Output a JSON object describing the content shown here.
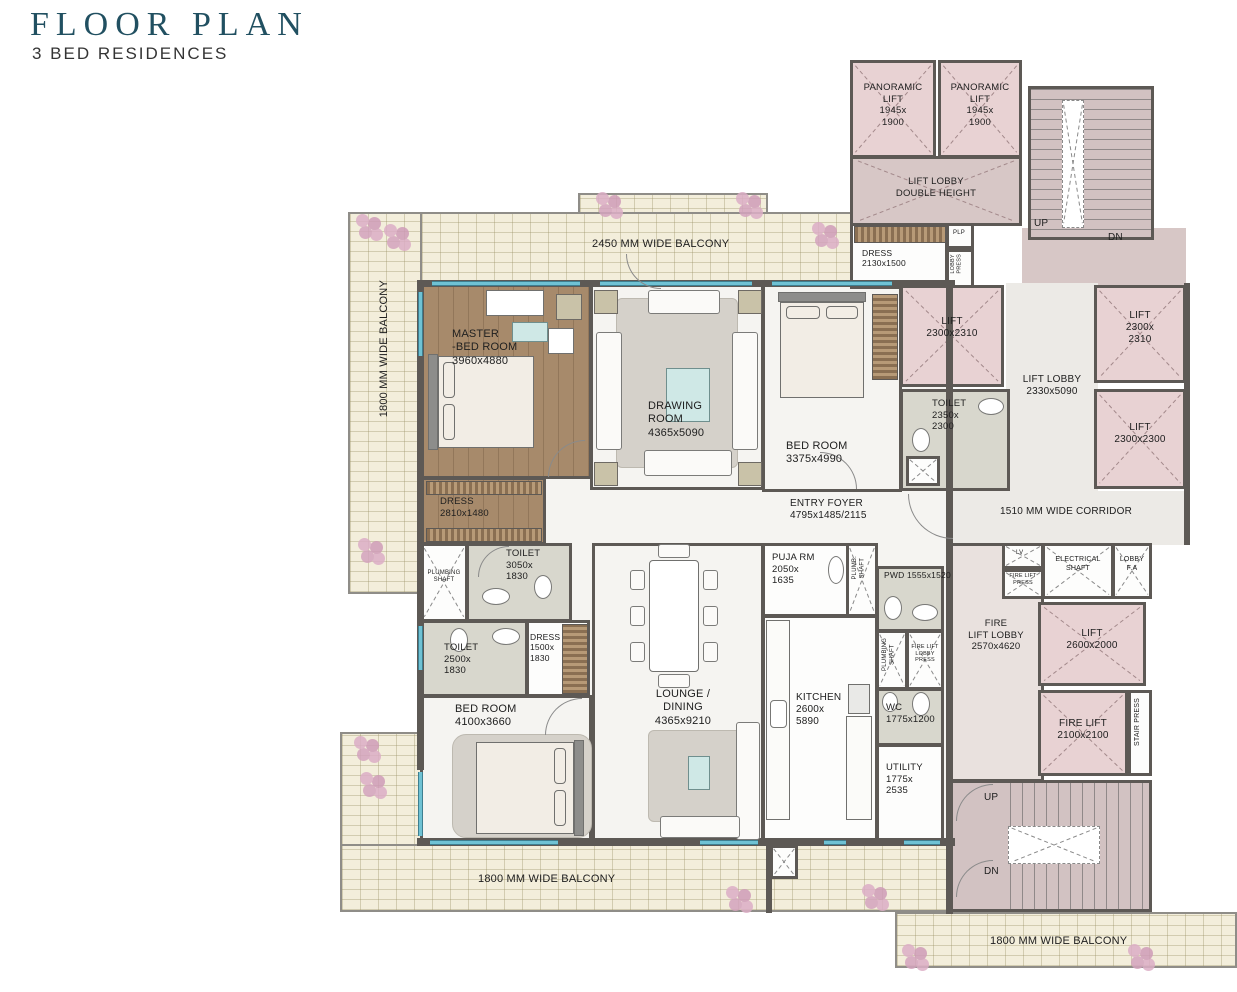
{
  "header": {
    "title": "FLOOR PLAN",
    "subtitle": "3 BED RESIDENCES"
  },
  "colors": {
    "accent_teal": "#215061",
    "wall": "#5d5955",
    "lift_fill": "#e8d2d3",
    "lobby_fill": "#d7c7c6",
    "balcony_tile": "#f3eedb",
    "wood_floor": "#a78a6b",
    "window_glass": "#6fc2d4"
  },
  "balconies": {
    "top": "2450 MM WIDE BALCONY",
    "left": "1800 MM WIDE BALCONY",
    "bottom": "1800 MM WIDE BALCONY",
    "bottom_right": "1800 MM WIDE BALCONY"
  },
  "corridor": {
    "label": "1510 MM WIDE CORRIDOR"
  },
  "stairs": {
    "up": "UP",
    "dn": "DN"
  },
  "rooms": {
    "panoramic_lift": {
      "name": "PANORAMIC\nLIFT",
      "dims": "1945x\n1900"
    },
    "lift_lobby_dh": {
      "name": "LIFT LOBBY\nDOUBLE HEIGHT"
    },
    "dress_top": {
      "name": "DRESS",
      "dims": "2130x1500"
    },
    "plp": {
      "name": "PLP"
    },
    "lobby_press": {
      "name": "LOBBY\nPRESS"
    },
    "master": {
      "name": "MASTER\n-BED ROOM",
      "dims": "3960x4880"
    },
    "drawing": {
      "name": "DRAWING\nROOM",
      "dims": "4365x5090"
    },
    "bed2": {
      "name": "BED ROOM",
      "dims": "3375x4990"
    },
    "lift_a": {
      "name": "LIFT",
      "dims": "2300x2310"
    },
    "toilet3": {
      "name": "TOILET",
      "dims": "2350x\n2300"
    },
    "lift_lobby": {
      "name": "LIFT LOBBY",
      "dims": "2330x5090"
    },
    "lift_b": {
      "name": "LIFT",
      "dims": "2300x\n2310"
    },
    "lift_c": {
      "name": "LIFT",
      "dims": "2300x2300"
    },
    "entry_foyer": {
      "name": "ENTRY FOYER",
      "dims": "4795x1485/2115"
    },
    "dress1": {
      "name": "DRESS",
      "dims": "2810x1480"
    },
    "plumbing_shaft_a": {
      "name": "PLUMBING\nSHAFT"
    },
    "toilet1": {
      "name": "TOILET",
      "dims": "3050x\n1830"
    },
    "toilet2": {
      "name": "TOILET",
      "dims": "2500x\n1830"
    },
    "dress2": {
      "name": "DRESS",
      "dims": "1500x\n1830"
    },
    "bed3": {
      "name": "BED ROOM",
      "dims": "4100x3660"
    },
    "lounge": {
      "name": "LOUNGE /\nDINING",
      "dims": "4365x9210"
    },
    "puja": {
      "name": "PUJA RM",
      "dims": "2050x\n1635"
    },
    "plumb_shaft_b": {
      "name": "PLUMB.\nSHAFT"
    },
    "pwd": {
      "name": "PWD",
      "dims": "1555x1520"
    },
    "plumbing_shaft_c": {
      "name": "PLUMBING\nSHAFT"
    },
    "fire_lift_lobby_press": {
      "name": "FIRE LIFT\nLOBBY\nPRESS"
    },
    "kitchen": {
      "name": "KITCHEN",
      "dims": "2600x\n5890"
    },
    "wc": {
      "name": "WC",
      "dims": "1775x1200"
    },
    "utility": {
      "name": "UTILITY",
      "dims": "1775x\n2535"
    },
    "fire_lift_lobby": {
      "name": "FIRE\nLIFT LOBBY",
      "dims": "2570x4620"
    },
    "lv": {
      "name": "LV"
    },
    "fire_lift_press": {
      "name": "FIRE LIFT\nPRESS"
    },
    "electrical_shaft": {
      "name": "ELECTRICAL\nSHAFT"
    },
    "lobby_fa": {
      "name": "LOBBY\nF.A"
    },
    "lift_d": {
      "name": "LIFT",
      "dims": "2600x2000"
    },
    "fire_lift": {
      "name": "FIRE LIFT",
      "dims": "2100x2100"
    },
    "stair_press": {
      "name": "STAIR PRESS"
    }
  }
}
